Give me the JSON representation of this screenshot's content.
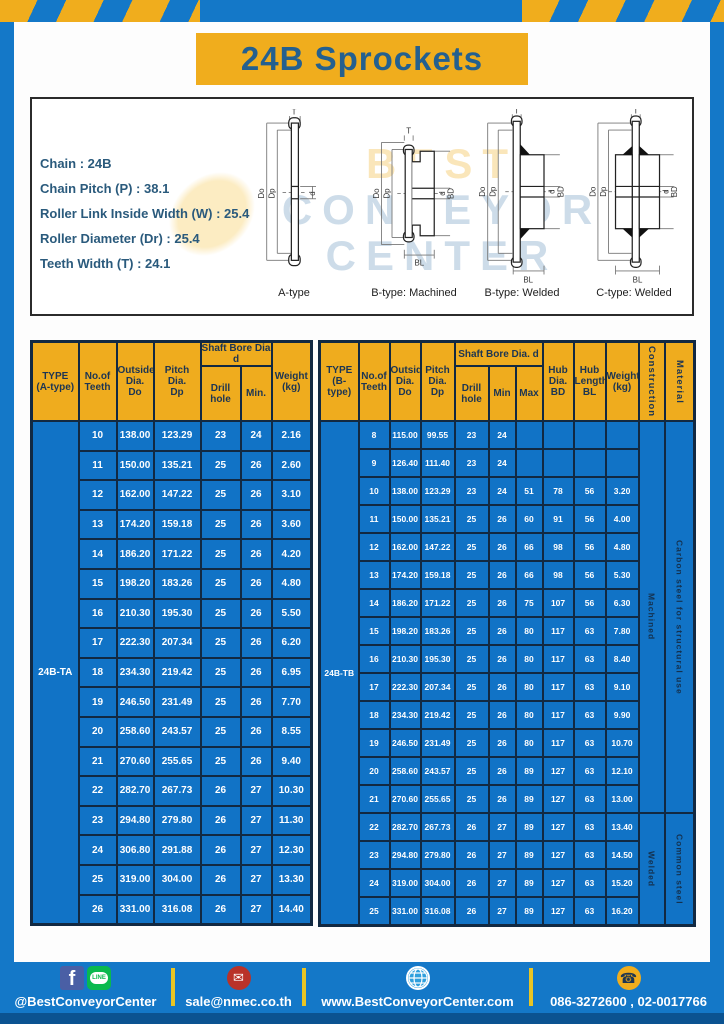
{
  "title_banner": "24B Sprockets",
  "specs": {
    "lines": [
      "Chain : 24B",
      "Chain Pitch (P) : 38.1",
      "Roller Link Inside Width (W) : 25.4",
      "Roller Diameter (Dr) : 25.4",
      "Teeth Width (T) : 24.1"
    ]
  },
  "diagram": {
    "watermark": [
      "BEST",
      "CONVEYOR",
      "CENTER"
    ],
    "dims": {
      "t": "T",
      "do": "Do",
      "dp": "Dp",
      "d": "d",
      "bd": "BD",
      "bl": "BL"
    },
    "figures": [
      {
        "caption": "A-type"
      },
      {
        "caption": "B-type: Machined"
      },
      {
        "caption": "B-type: Welded"
      },
      {
        "caption": "C-type: Welded"
      }
    ]
  },
  "table_a": {
    "type_label": "24B-TA",
    "headers": {
      "type": "TYPE\n(A-type)",
      "teeth": "No.of\nTeeth",
      "outside": "Outside\nDia.\nDo",
      "pitch": "Pitch Dia.\nDp",
      "shaft": "Shaft Bore Dia d",
      "drill": "Drill hole",
      "min": "Min.",
      "weight": "Weight\n(kg)"
    },
    "rows": [
      [
        "10",
        "138.00",
        "123.29",
        "23",
        "24",
        "2.16"
      ],
      [
        "11",
        "150.00",
        "135.21",
        "25",
        "26",
        "2.60"
      ],
      [
        "12",
        "162.00",
        "147.22",
        "25",
        "26",
        "3.10"
      ],
      [
        "13",
        "174.20",
        "159.18",
        "25",
        "26",
        "3.60"
      ],
      [
        "14",
        "186.20",
        "171.22",
        "25",
        "26",
        "4.20"
      ],
      [
        "15",
        "198.20",
        "183.26",
        "25",
        "26",
        "4.80"
      ],
      [
        "16",
        "210.30",
        "195.30",
        "25",
        "26",
        "5.50"
      ],
      [
        "17",
        "222.30",
        "207.34",
        "25",
        "26",
        "6.20"
      ],
      [
        "18",
        "234.30",
        "219.42",
        "25",
        "26",
        "6.95"
      ],
      [
        "19",
        "246.50",
        "231.49",
        "25",
        "26",
        "7.70"
      ],
      [
        "20",
        "258.60",
        "243.57",
        "25",
        "26",
        "8.55"
      ],
      [
        "21",
        "270.60",
        "255.65",
        "25",
        "26",
        "9.40"
      ],
      [
        "22",
        "282.70",
        "267.73",
        "26",
        "27",
        "10.30"
      ],
      [
        "23",
        "294.80",
        "279.80",
        "26",
        "27",
        "11.30"
      ],
      [
        "24",
        "306.80",
        "291.88",
        "26",
        "27",
        "12.30"
      ],
      [
        "25",
        "319.00",
        "304.00",
        "26",
        "27",
        "13.30"
      ],
      [
        "26",
        "331.00",
        "316.08",
        "26",
        "27",
        "14.40"
      ]
    ]
  },
  "table_b": {
    "type_label": "24B-TB",
    "headers": {
      "type": "TYPE\n(B-type)",
      "teeth": "No.of\nTeeth",
      "outside": "Outside\nDia.\nDo",
      "pitch": "Pitch\nDia.\nDp",
      "shaft": "Shaft Bore Dia.  d",
      "drill": "Drill hole",
      "min": "Min",
      "max": "Max",
      "hub_dia": "Hub\nDia.\nBD",
      "hub_len": "Hub\nLength\nBL",
      "weight": "Weight\n(kg)",
      "construction": "Construction",
      "material": "Material"
    },
    "rows": [
      [
        "8",
        "115.00",
        "99.55",
        "23",
        "24",
        "",
        "",
        "",
        ""
      ],
      [
        "9",
        "126.40",
        "111.40",
        "23",
        "24",
        "",
        "",
        "",
        ""
      ],
      [
        "10",
        "138.00",
        "123.29",
        "23",
        "24",
        "51",
        "78",
        "56",
        "3.20"
      ],
      [
        "11",
        "150.00",
        "135.21",
        "25",
        "26",
        "60",
        "91",
        "56",
        "4.00"
      ],
      [
        "12",
        "162.00",
        "147.22",
        "25",
        "26",
        "66",
        "98",
        "56",
        "4.80"
      ],
      [
        "13",
        "174.20",
        "159.18",
        "25",
        "26",
        "66",
        "98",
        "56",
        "5.30"
      ],
      [
        "14",
        "186.20",
        "171.22",
        "25",
        "26",
        "75",
        "107",
        "56",
        "6.30"
      ],
      [
        "15",
        "198.20",
        "183.26",
        "25",
        "26",
        "80",
        "117",
        "63",
        "7.80"
      ],
      [
        "16",
        "210.30",
        "195.30",
        "25",
        "26",
        "80",
        "117",
        "63",
        "8.40"
      ],
      [
        "17",
        "222.30",
        "207.34",
        "25",
        "26",
        "80",
        "117",
        "63",
        "9.10"
      ],
      [
        "18",
        "234.30",
        "219.42",
        "25",
        "26",
        "80",
        "117",
        "63",
        "9.90"
      ],
      [
        "19",
        "246.50",
        "231.49",
        "25",
        "26",
        "80",
        "117",
        "63",
        "10.70"
      ],
      [
        "20",
        "258.60",
        "243.57",
        "25",
        "26",
        "89",
        "127",
        "63",
        "12.10"
      ],
      [
        "21",
        "270.60",
        "255.65",
        "25",
        "26",
        "89",
        "127",
        "63",
        "13.00"
      ],
      [
        "22",
        "282.70",
        "267.73",
        "26",
        "27",
        "89",
        "127",
        "63",
        "13.40"
      ],
      [
        "23",
        "294.80",
        "279.80",
        "26",
        "27",
        "89",
        "127",
        "63",
        "14.50"
      ],
      [
        "24",
        "319.00",
        "304.00",
        "26",
        "27",
        "89",
        "127",
        "63",
        "15.20"
      ],
      [
        "25",
        "331.00",
        "316.08",
        "26",
        "27",
        "89",
        "127",
        "63",
        "16.20"
      ]
    ],
    "construction_groups": [
      {
        "label": "Machined",
        "material": "Carbon  steel  for  structural  use",
        "span": 14
      },
      {
        "label": "Welded",
        "material": "Common  steel",
        "span": 4
      }
    ]
  },
  "footer": {
    "facebook_letter": "f",
    "line_label": "LINE",
    "social_handle": "@BestConveyorCenter",
    "email": "sale@nmec.co.th",
    "website": "www.BestConveyorCenter.com",
    "phones": "086-3272600 , 02-0017766",
    "mail_glyph": "✉",
    "phone_glyph": "☎"
  },
  "colors": {
    "blue": "#1478c8",
    "cell_blue": "#1173c6",
    "yellow": "#f0ad1d",
    "dark_navy": "#122942",
    "footer_stripe": "#0b5391"
  }
}
